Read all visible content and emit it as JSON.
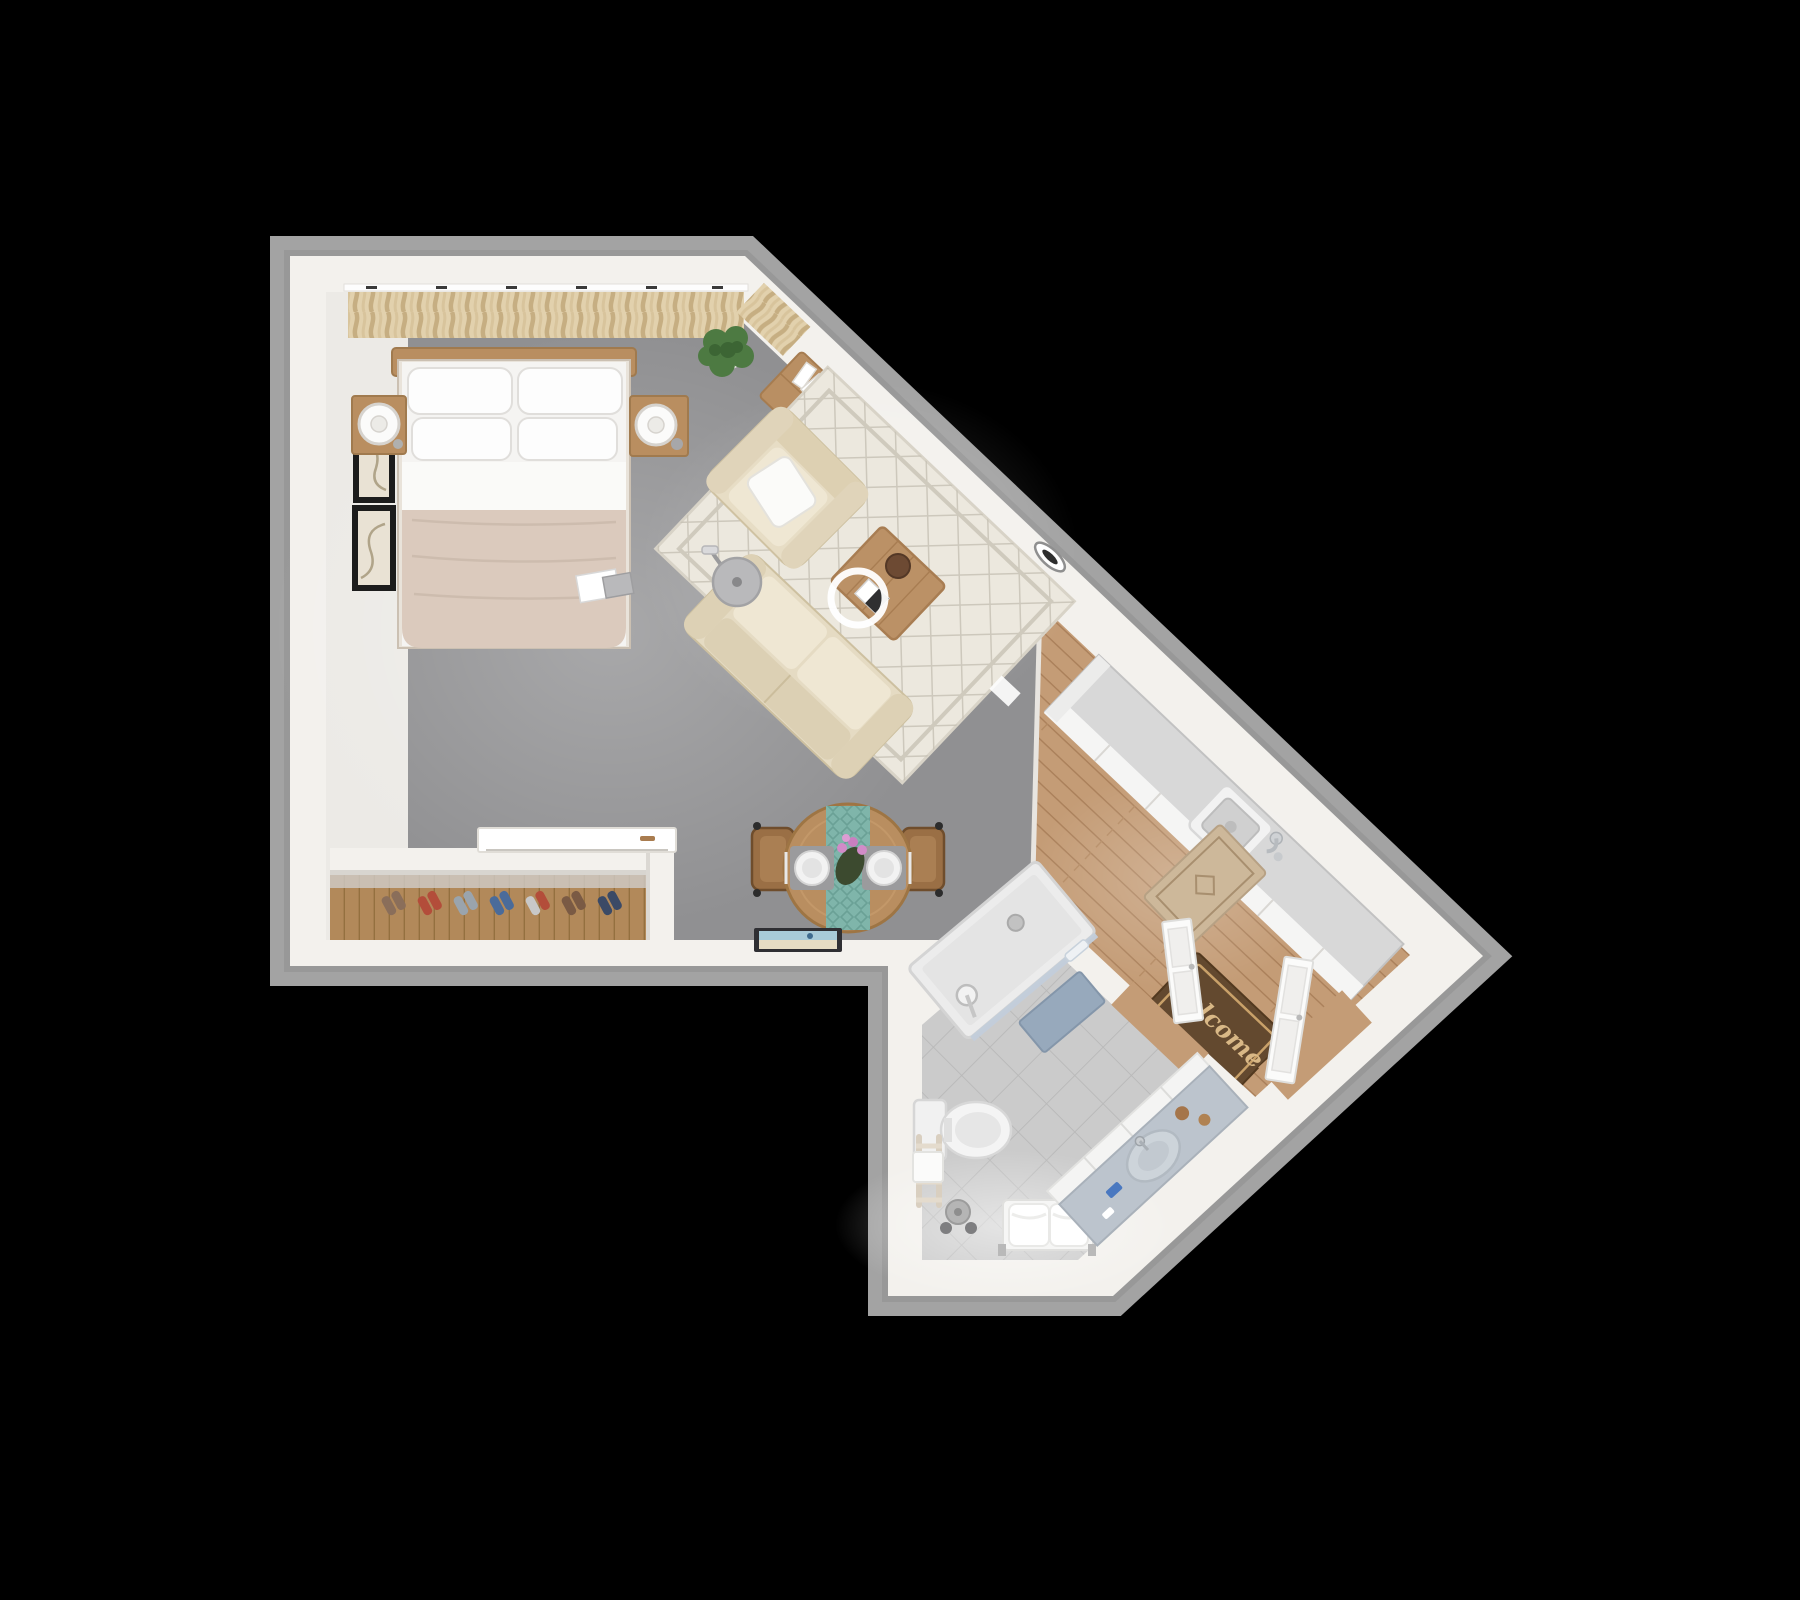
{
  "scene": {
    "type": "3d-floor-plan-top-view",
    "description": "Top-down 3D render of a studio apartment shaped like an arrow pointing right, on a black background",
    "background_color": "#000000",
    "wall_color": "#f3f1ed",
    "wall_rim_color": "#a3a3a3"
  },
  "rooms": [
    {
      "name": "bedroom-living-area",
      "floor": "gray carpet",
      "floor_color": "#909092",
      "items": [
        "double bed with beige duvet and four white pillows",
        "wood headboard",
        "left nightstand with round white lamp",
        "right nightstand with round white lamp",
        "cream pleated curtains along top wall",
        "two framed abstract artworks",
        "potted plant",
        "beige armchair with white pillow",
        "beige sofa",
        "cream diamond-pattern area rug",
        "wood coffee table with tray",
        "white ring pendant lamp",
        "gray arc floor lamp",
        "wood TV console with flat TV",
        "round wood dining table with teal runner, two place settings and orchid",
        "two wood dining chairs",
        "open closet nook with shoes",
        "white dresser",
        "framed beach picture leaning on wall"
      ]
    },
    {
      "name": "kitchen-entry",
      "floor": "wood planks",
      "floor_color": "#c49c76",
      "items": [
        "white kitchen counter with square sink and faucet",
        "beige diamond kitchen mat",
        "welcome door mat",
        "open white entry door",
        "oval wall mirror on diagonal wall"
      ]
    },
    {
      "name": "bathroom",
      "floor": "light gray diagonal tile",
      "floor_color": "#cbcbcb",
      "items": [
        "corner shower with glass door and hand shower",
        "blue bath mat",
        "white toilet",
        "wood towel ladder with towel",
        "toilet paper stand",
        "white bench with two towels",
        "diagonal vanity with round sink and toiletries",
        "open white bathroom door"
      ]
    }
  ],
  "welcome_mat": {
    "text": "Welcome"
  },
  "palette": {
    "carpet": "#909092",
    "wood_floor": "#c49c76",
    "closet_wood": "#b2895a",
    "tile": "#cbcbcb",
    "sofa_beige": "#e6dcc4",
    "rug_cream": "#ece8de",
    "furniture_wood": "#b98e60",
    "duvet": "#dbcabd",
    "curtain": "#e2d1ad",
    "runner_teal": "#7fb5aa",
    "bath_mat_blue": "#97a9bc",
    "tv_dark": "#35373b",
    "welcome_mat_brown": "#63492f",
    "vanity_top": "#bcc4cd"
  }
}
